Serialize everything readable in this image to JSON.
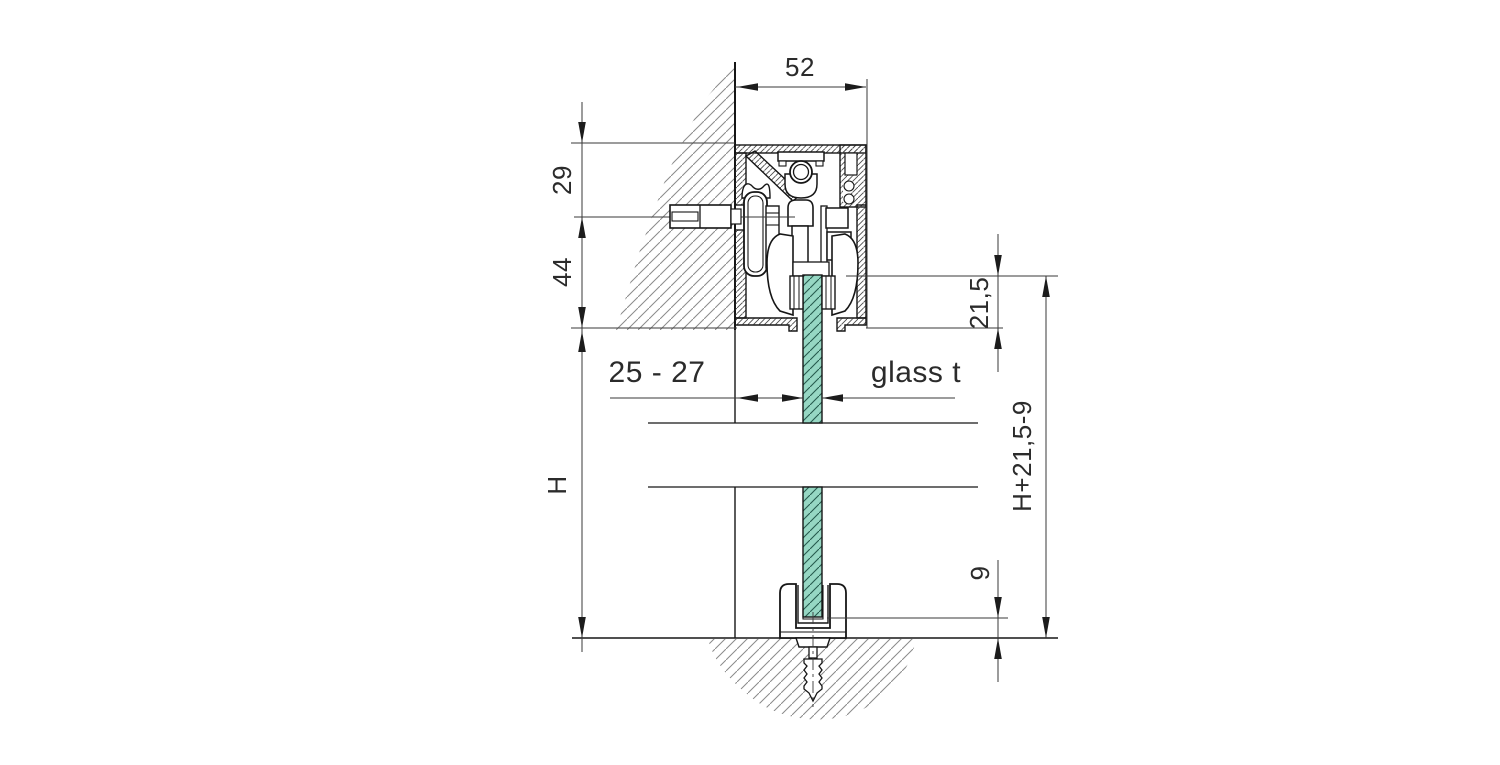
{
  "drawing": {
    "type": "technical-section",
    "description": "Cross-section of wall-mounted sliding glass door track with floor guide",
    "labels": {
      "track_width": "52",
      "top_to_bolt": "29",
      "bolt_to_track_bottom": "44",
      "door_height": "H",
      "wall_to_glass": "25 - 27",
      "glass_thickness": "glass t",
      "top_engagement": "21,5",
      "overall_height": "H+21,5-9",
      "floor_engagement": "9"
    },
    "colors": {
      "glass_fill": "#96d7c3",
      "glass_hatch": "#265a4d",
      "outline": "#161616",
      "dimension_line": "#3a3a3a",
      "wall_hatch": "#8a8a8a",
      "profile_hatch": "#4a4a4a"
    }
  }
}
